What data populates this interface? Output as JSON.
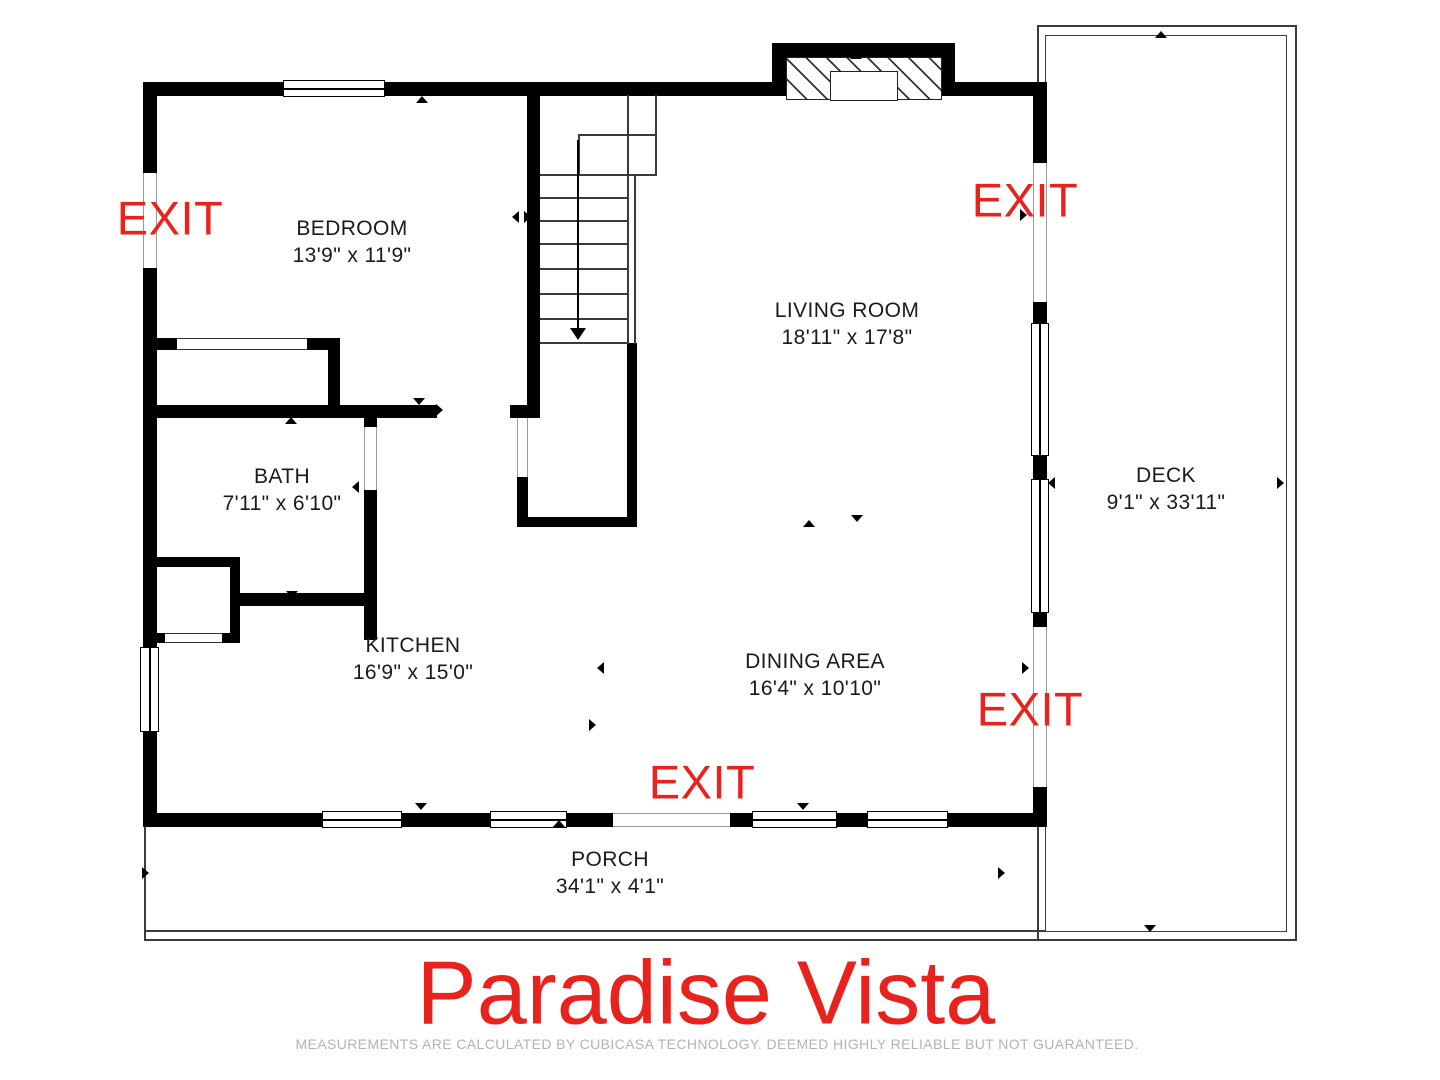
{
  "title": "Paradise Vista",
  "disclaimer": "MEASUREMENTS ARE CALCULATED BY CUBICASA TECHNOLOGY. DEEMED HIGHLY RELIABLE BUT NOT GUARANTEED.",
  "labels": {
    "exit": "EXIT"
  },
  "colors": {
    "accent_red": "#e8221c",
    "wall_black": "#000000",
    "disclaimer_gray": "#b3b3b3"
  },
  "rooms": {
    "bedroom": {
      "name": "BEDROOM",
      "dims": "13'9\" x 11'9\""
    },
    "living_room": {
      "name": "LIVING ROOM",
      "dims": "18'11\" x 17'8\""
    },
    "bath": {
      "name": "BATH",
      "dims": "7'11\" x 6'10\""
    },
    "kitchen": {
      "name": "KITCHEN",
      "dims": "16'9\" x 15'0\""
    },
    "dining_area": {
      "name": "DINING AREA",
      "dims": "16'4\" x 10'10\""
    },
    "deck": {
      "name": "DECK",
      "dims": "9'1\" x 33'11\""
    },
    "porch": {
      "name": "PORCH",
      "dims": "34'1\" x 4'1\""
    }
  }
}
